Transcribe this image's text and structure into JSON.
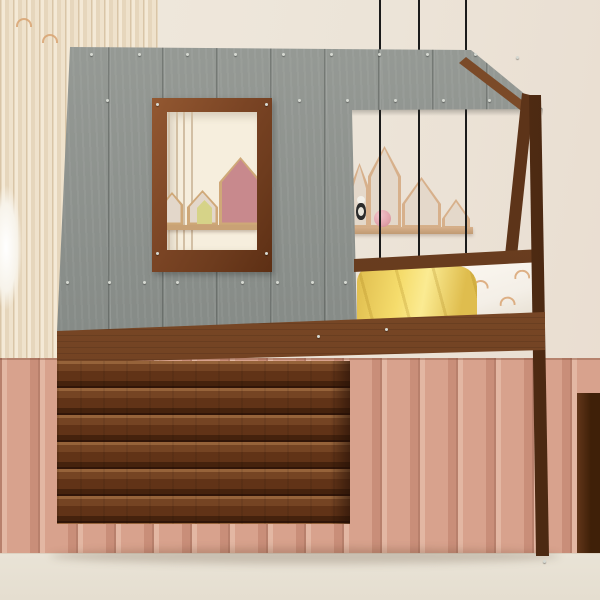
{
  "scene": {
    "type": "product-photo",
    "subject": "kids house-shaped twin-over-twin bunk bed with gray plank roof, roof window, log-cabin lower facade and ladder",
    "room": "children's bedroom staged with plush toys"
  },
  "objects": [
    "gray wood roof panel with screws",
    "roof window with brown wood frame",
    "house-shaped shelf decor seen through roof window",
    "pink house wall decor",
    "house-shaped wall shelf with four compartments",
    "pink ball in shelf",
    "small plush doll hanging in shelf",
    "three black pendant cables",
    "A-frame gable posts",
    "upper bunk with yellow blanket and white rainbow-print comforter",
    "lower bunk with yellow blanket, white pillow and rainbow-print comforter",
    "wooden ladder with three rungs",
    "log cabin facade with window",
    "bunny plush sitting in cabin window",
    "vertical slat accent wall",
    "terracotta wainscot panels",
    "cream nightstand with round foot",
    "striped toy on nightstand",
    "pink whale plush on floor",
    "pink toy car with teddy",
    "dark cabinet at right edge",
    "cream carpet floor"
  ],
  "palette": {
    "wall": "#ece4d8",
    "slat_light": "#f4e9d6",
    "slat_dark": "#d9c5a7",
    "wainscot": "#d8a28d",
    "wainscot_hi": "#e3b7a3",
    "wainscot_sh": "#b8806c",
    "floor": "#e9e3d6",
    "roof": "#868b87",
    "roof_hi": "#989c97",
    "roof_sh": "#747974",
    "walnut": "#5d3419",
    "walnut_hi": "#7b4a28",
    "frame": "#7a4424",
    "frame_hi": "#935831",
    "log": "#754423",
    "base_band": "#44240f",
    "yellow": "#f5dc6c",
    "yellow_hi": "#fbeb92",
    "yellow_sh": "#dfbd4e",
    "white_bed": "#f4efe7",
    "shelf_wood": "#d7b08b",
    "shelf_in": "#e4d8ca",
    "house_pink": "#c8898d",
    "mini_house": "#d6d388",
    "ball_pink": "#e2a3ac",
    "plush": "#f6e2e3",
    "plush_sh": "#e8c6ca",
    "car_pink": "#f0c6d3",
    "bunny_head": "#f0e7d9",
    "bunny_pink": "#ecb2aa",
    "bunny_skirt": "#c795ae",
    "cable": "#1b1b1b",
    "nightstand": "#f1e9d8",
    "cream_int": "#f6eedd",
    "screw": "#d6d9d2"
  }
}
